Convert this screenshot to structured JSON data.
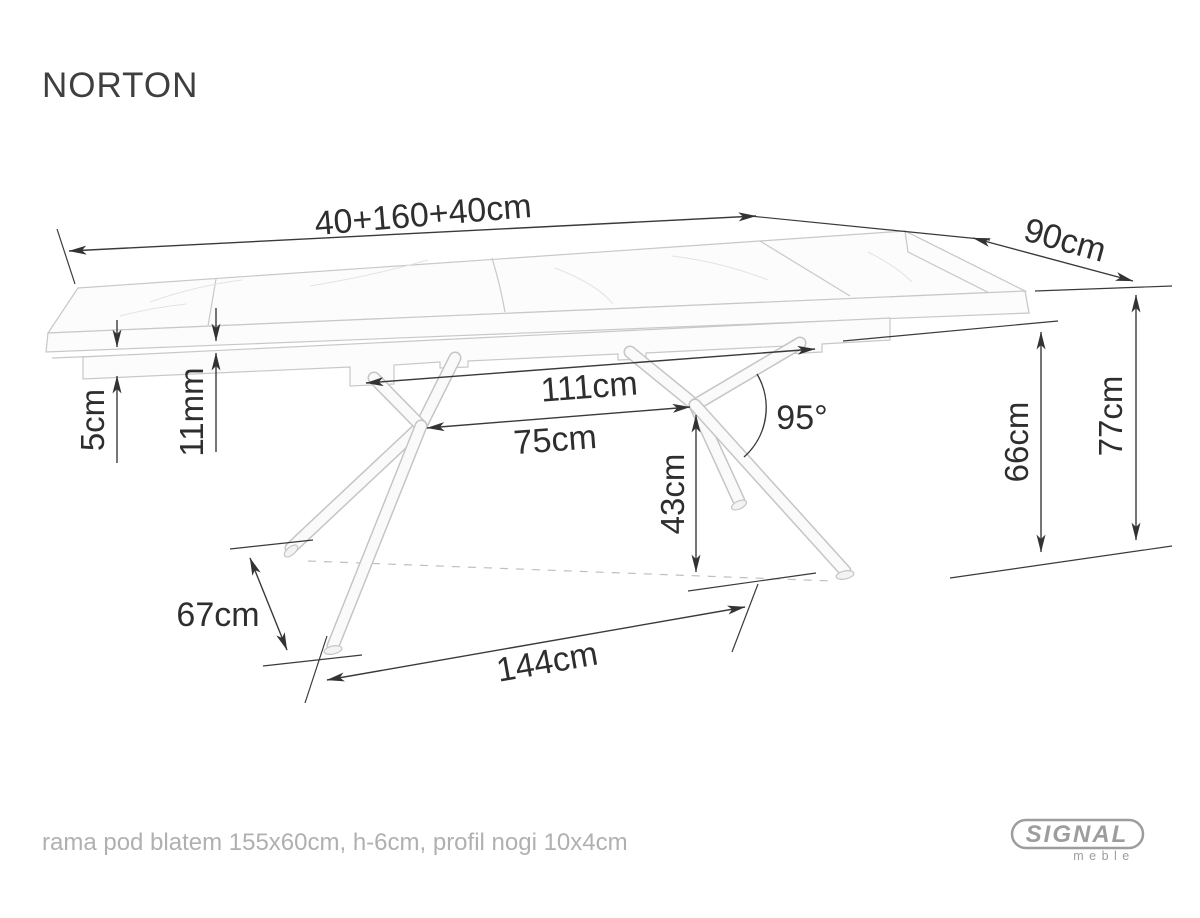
{
  "title": "NORTON",
  "diagram": {
    "dimensions": {
      "tabletop_length": "40+160+40cm",
      "tabletop_depth": "90cm",
      "tabletop_thickness": "5cm",
      "leaf_step": "11mm",
      "leg_mount_span": "111cm",
      "leg_hub_span": "75cm",
      "hub_height": "43cm",
      "leg_angle": "95°",
      "clearance_height": "66cm",
      "table_height": "77cm",
      "foot_depth": "67cm",
      "foot_span": "144cm"
    }
  },
  "footer": {
    "note": "rama pod blatem 155x60cm, h-6cm, profil nogi 10x4cm"
  },
  "logo": {
    "brand": "SIGNAL",
    "subbrand": "meble"
  },
  "colors": {
    "dimension_lines": "#3a3a3a",
    "drawing_lines": "#c8c8c8",
    "note_text": "#b0b0b0",
    "logo_gray": "#9d9d9d",
    "background": "#ffffff"
  }
}
